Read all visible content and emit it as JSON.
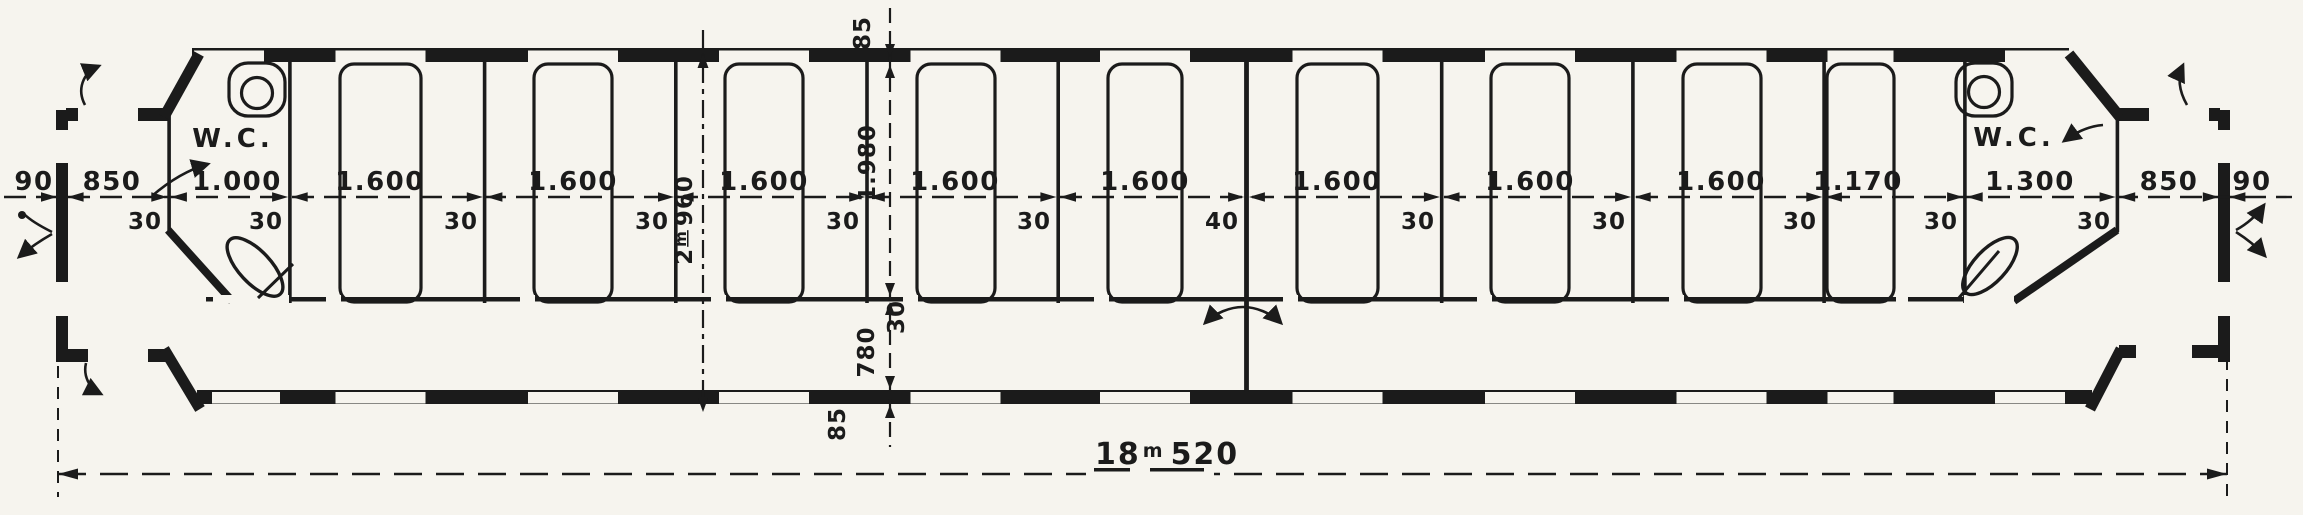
{
  "plan": {
    "left_end": {
      "wall_thickness": "90",
      "platform_width": "850",
      "wc": {
        "label": "W.C.",
        "width": "1.000"
      }
    },
    "right_end": {
      "wall_thickness": "90",
      "platform_width": "850",
      "wc": {
        "label": "W.C.",
        "width": "1.300"
      }
    },
    "compartments": [
      "1.600",
      "1.600",
      "1.600",
      "1.600",
      "1.600",
      "1.600",
      "1.600",
      "1.600"
    ],
    "half_compartment": "1.170",
    "partition_labels": [
      "30",
      "30",
      "30",
      "30",
      "30",
      "30",
      "40",
      "30",
      "30",
      "30",
      "30",
      "30"
    ],
    "cross": {
      "outer_wall_top": "85",
      "compartment_depth": "1.980",
      "corridor_wall": "30",
      "corridor_width": "780",
      "outer_wall_bottom": "85",
      "overall_width": {
        "metres": "2",
        "unit": "m",
        "millimetres": "960"
      }
    },
    "overall_length": {
      "metres": "18",
      "unit": "m",
      "millimetres": "520"
    }
  },
  "colors": {
    "ink": "#1b1b1b",
    "paper": "#f6f4ee"
  }
}
